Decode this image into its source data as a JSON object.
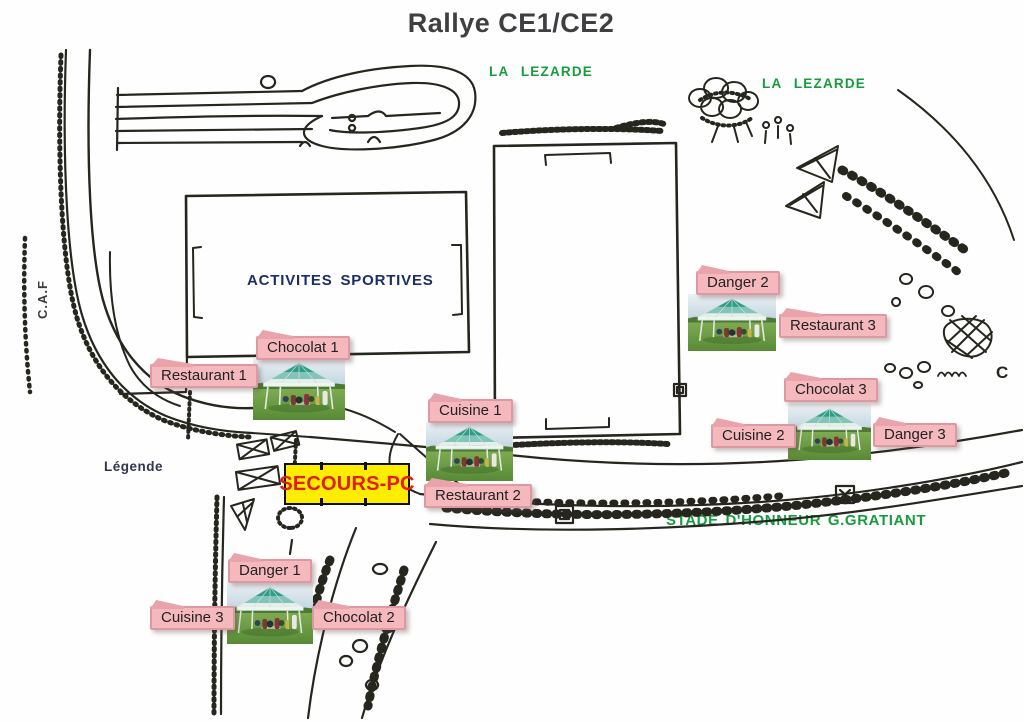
{
  "title": "Rallye CE1/CE2",
  "map_labels": {
    "river_1": "LA LEZARDE",
    "river_2": "LA LEZARDE",
    "sports_field": "ACTIVITES SPORTIVES",
    "road": "C.A.F",
    "legend": "Légende",
    "first_aid_post": "SECOURS-PC",
    "stadium": "STADE D'HONNEUR G.GRATIANT"
  },
  "stations": [
    {
      "name": "Chocolat 1"
    },
    {
      "name": "Restaurant 1"
    },
    {
      "name": "Cuisine 1"
    },
    {
      "name": "Restaurant 2"
    },
    {
      "name": "Danger 2"
    },
    {
      "name": "Restaurant 3"
    },
    {
      "name": "Chocolat 3"
    },
    {
      "name": "Cuisine 2"
    },
    {
      "name": "Danger 3"
    },
    {
      "name": "Danger 1"
    },
    {
      "name": "Cuisine 3"
    },
    {
      "name": "Chocolat 2"
    }
  ],
  "tent_photo_count": 5,
  "colors": {
    "station_label_bg": "#f5b8bd",
    "station_label_border": "#db9aa1",
    "green_text": "#169c3e",
    "field_text_navy": "#1c2d6b",
    "legend_text": "#33344d",
    "secours_bg": "#ffed00",
    "secours_text": "#e21d12",
    "ink": "#26261f",
    "title_text": "#3f3f41"
  }
}
